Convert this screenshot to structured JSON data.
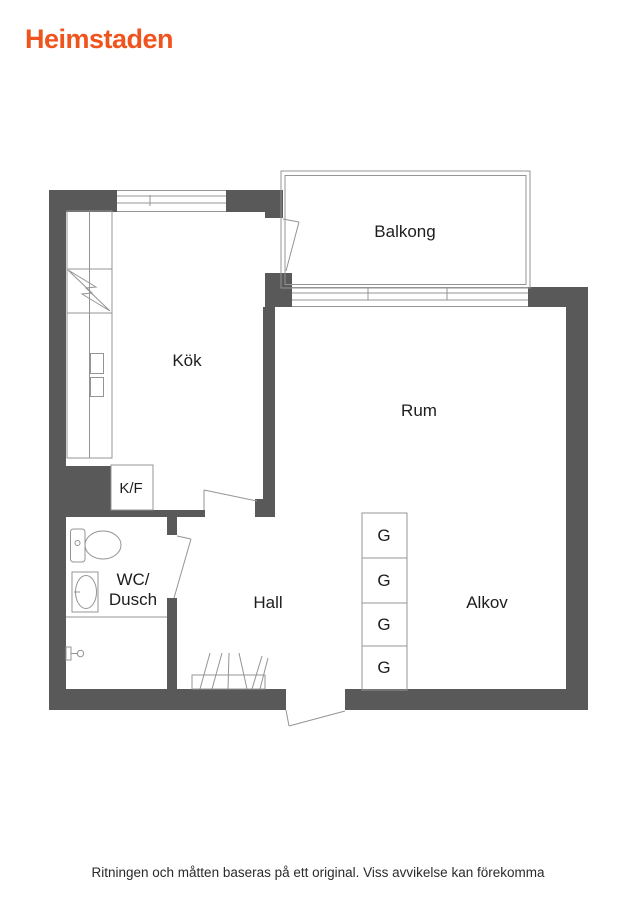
{
  "brand": {
    "logo_text": "Heimstaden",
    "color": "#f0541e"
  },
  "floorplan": {
    "rooms": {
      "balkong": "Balkong",
      "kok": "Kök",
      "rum": "Rum",
      "hall": "Hall",
      "alkov": "Alkov",
      "wc_line1": "WC/",
      "wc_line2": "Dusch",
      "kf": "K/F",
      "wardrobe": "G"
    },
    "wardrobe_count": 4,
    "colors": {
      "wall_gray": "#595959",
      "line_gray": "#949494",
      "label_black": "#1d1d1d"
    }
  },
  "footer": {
    "disclaimer": "Ritningen och måtten baseras på ett original. Viss avvikelse kan förekomma"
  }
}
